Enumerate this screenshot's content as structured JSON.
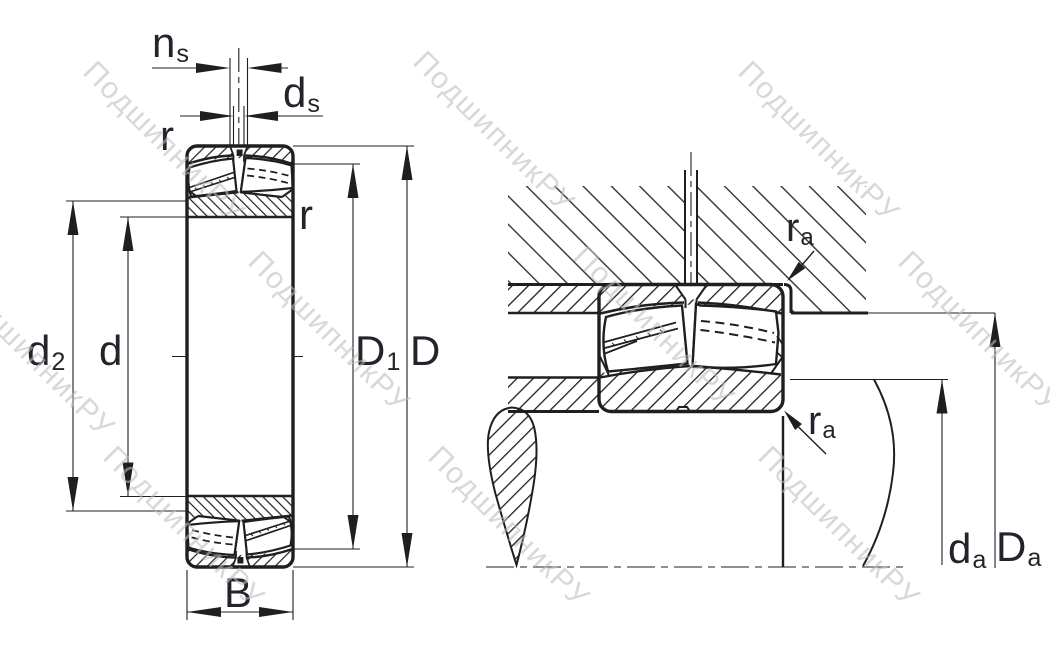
{
  "canvas": {
    "width": 1050,
    "height": 650,
    "background": "#ffffff",
    "line_color": "#1f1f1f",
    "label_color": "#23232b"
  },
  "watermark": {
    "text": "ПодшипникРУ",
    "color": "#bdbdbd"
  },
  "left_view": {
    "description": "spherical roller bearing cross-section",
    "labels": {
      "ns": {
        "main": "n",
        "sub": "s"
      },
      "ds": {
        "main": "d",
        "sub": "s"
      },
      "r_top": {
        "main": "r"
      },
      "r_side": {
        "main": "r"
      },
      "d2": {
        "main": "d",
        "sub": "2"
      },
      "d": {
        "main": "d"
      },
      "D1": {
        "main": "D",
        "sub": "1"
      },
      "D": {
        "main": "D"
      },
      "B": {
        "main": "B"
      }
    }
  },
  "right_view": {
    "description": "bearing mounted in housing on shaft - abutment dimensions",
    "labels": {
      "ra_housing": {
        "main": "r",
        "sub": "a"
      },
      "ra_shaft": {
        "main": "r",
        "sub": "a"
      },
      "da": {
        "main": "d",
        "sub": "a"
      },
      "Da": {
        "main": "D",
        "sub": "a"
      }
    }
  }
}
